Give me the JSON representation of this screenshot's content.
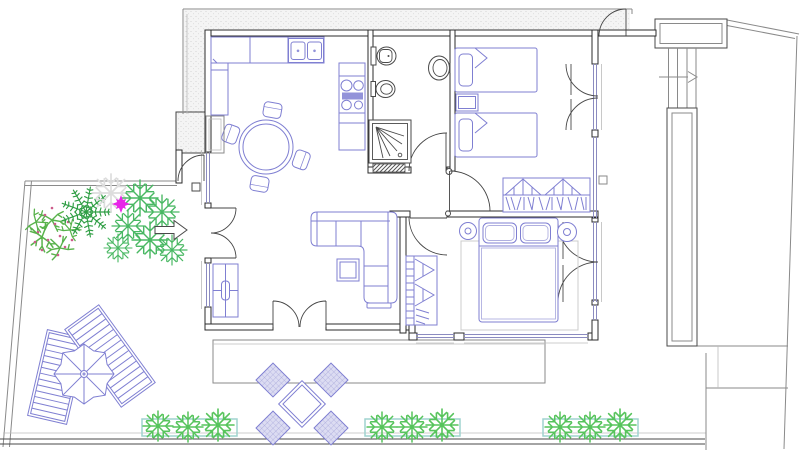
{
  "document": {
    "type": "architectural floor plan (CAD drawing, no text labels)",
    "description": "Apartment floor plan: kitchen with L-counter, sink, cooktop and round dining table; bathroom with toilet, bidet, washbasin and shower; twin bedroom with two single beds, nightstand and wardrobe; double bedroom with double bed, two round nightstands, rug and wardrobe; living room with corner sofa, coffee table and sideboard; garden with palm, shrubs and magenta flower with entrance arrow; sun deck with two loungers and parasol; terrace with outdoor table, four chairs and three planter boxes; external stair landing with direction arrow",
    "visible_text": []
  },
  "colors": {
    "wall": "#2b2b2b",
    "fixture": "#4a4a4a",
    "outline": "#8a8a8a",
    "light": "#bbbbbb",
    "furniture": "#7f7fd2",
    "furnlight": "#b0b0e0",
    "glazing": "#8b8bc0",
    "rug": "#cccccc",
    "planter": "#9fd4cf",
    "plant": "#57c45c",
    "plantbush": "#58b24b",
    "plantdark": "#2f9e44",
    "plantoutline": "#49b863",
    "blossom": "#cc5b8a",
    "flower": "#e824e8"
  },
  "rooms": [
    {
      "id": "kitchen",
      "elements": [
        "l-shaped-counter",
        "refrigerator",
        "double-sink",
        "cooktop-4-burners",
        "round-dining-table",
        "chairs-x4"
      ]
    },
    {
      "id": "bathroom",
      "elements": [
        "toilet",
        "bidet",
        "washbasin",
        "shower",
        "threshold",
        "door"
      ]
    },
    {
      "id": "bedroom-twin",
      "elements": [
        "single-bed-x2",
        "nightstand",
        "wardrobe-hanging-clothes",
        "casement-window"
      ]
    },
    {
      "id": "bedroom-double",
      "elements": [
        "double-bed",
        "round-nightstand-x2",
        "rug",
        "wardrobe-hanging-clothes",
        "casement-window"
      ]
    },
    {
      "id": "living-room",
      "elements": [
        "corner-sofa",
        "coffee-table",
        "sideboard",
        "radiator",
        "entry-double-door",
        "french-door"
      ]
    },
    {
      "id": "hallway",
      "elements": [
        "door-to-bathroom",
        "door-to-twin-bedroom",
        "door-to-double-bedroom"
      ]
    },
    {
      "id": "garden",
      "elements": [
        "palm-plant",
        "flowering-shrubs",
        "outline-shrubs",
        "magenta-flower",
        "entrance-arrow",
        "garden-gate",
        "gate-post"
      ]
    },
    {
      "id": "sun-deck",
      "elements": [
        "sun-lounger-x2",
        "parasol"
      ]
    },
    {
      "id": "terrace",
      "elements": [
        "paving-slab",
        "outdoor-table",
        "outdoor-chairs-x4",
        "planter-box-x3",
        "planter-plants-x9"
      ]
    },
    {
      "id": "external-stair",
      "elements": [
        "landing",
        "steps",
        "direction-arrow",
        "planter-strip",
        "terrace-door"
      ]
    }
  ]
}
